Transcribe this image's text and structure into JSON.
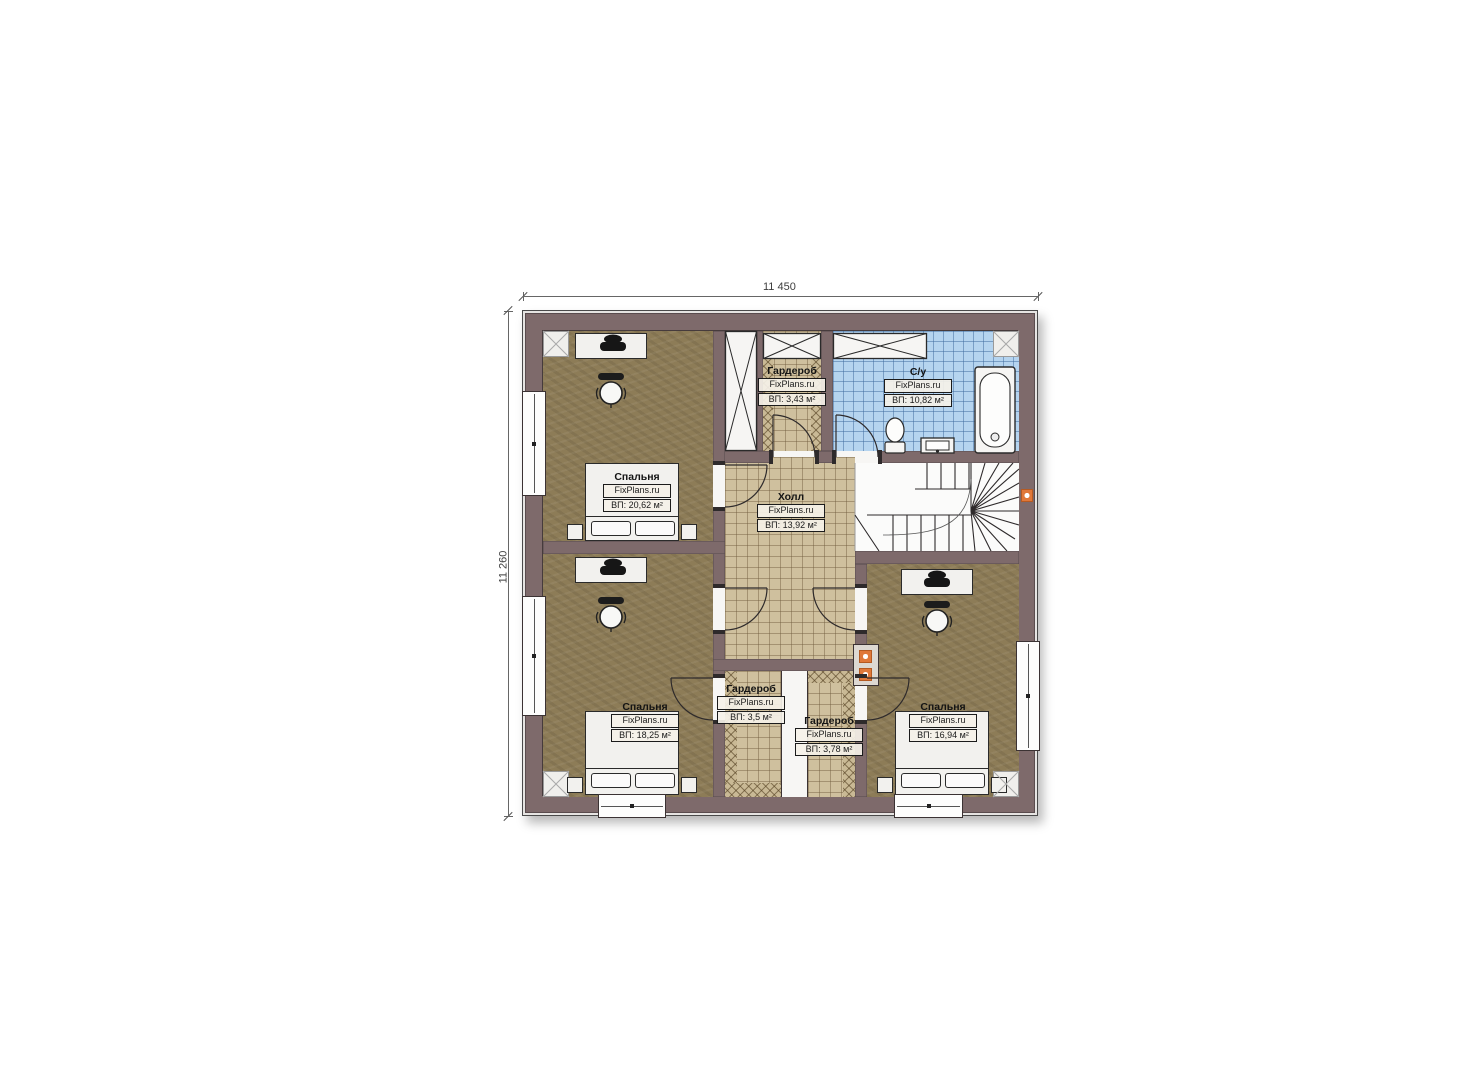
{
  "dimensions": {
    "width_label": "11 450",
    "height_label": "11 260"
  },
  "watermark": "FixPlans.ru",
  "rooms": [
    {
      "id": "bedroom-top-left",
      "name": "Спальня",
      "area": "ВП: 20,62 м²"
    },
    {
      "id": "wardrobe-top",
      "name": "Гардероб",
      "area": "ВП: 3,43 м²"
    },
    {
      "id": "bathroom",
      "name": "С/у",
      "area": "ВП: 10,82 м²"
    },
    {
      "id": "hall",
      "name": "Холл",
      "area": "ВП: 13,92 м²"
    },
    {
      "id": "bedroom-bottom-left",
      "name": "Спальня",
      "area": "ВП: 18,25 м²"
    },
    {
      "id": "wardrobe-bottom-1",
      "name": "Гардероб",
      "area": "ВП: 3,5 м²"
    },
    {
      "id": "wardrobe-bottom-2",
      "name": "Гардероб",
      "area": "ВП: 3,78 м²"
    },
    {
      "id": "bedroom-bottom-right",
      "name": "Спальня",
      "area": "ВП: 16,94 м²"
    }
  ],
  "colors": {
    "wall": "#7e6a6b",
    "wallband": "#e6e4e2",
    "wood": "#8d7c57",
    "tile": "#cfc09e",
    "btile": "#b5d4ef",
    "accent": "#e0783a",
    "line": "#3b3233"
  }
}
